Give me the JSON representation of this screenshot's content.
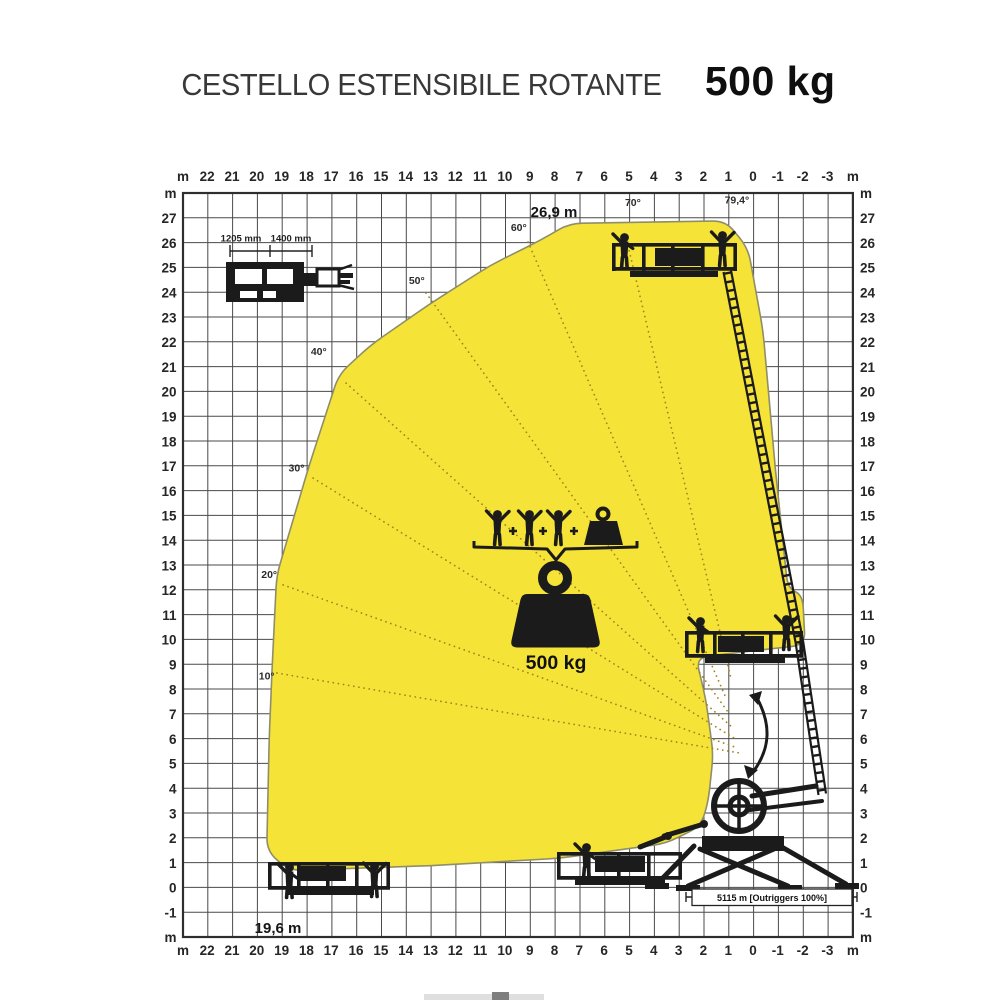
{
  "title": {
    "main": "CESTELLO ESTENSIBILE ROTANTE",
    "capacity": "500 kg"
  },
  "labels": {
    "unit": "m",
    "max_height": "26,9 m",
    "max_outreach": "19,6 m",
    "dim_width_1": "1205 mm",
    "dim_width_2": "1400 mm",
    "outriggers": "5115 m [Outriggers 100%]"
  },
  "pictogram": {
    "capacity_label": "500 kg",
    "persons_count": 3,
    "icons": [
      "person-icon",
      "plus-icon",
      "person-icon",
      "plus-icon",
      "person-icon",
      "plus-icon",
      "case-weight-icon",
      "brace-icon",
      "kettlebell-weight-icon"
    ]
  },
  "chart_data": {
    "type": "area",
    "title": "Working envelope - CESTELLO ESTENSIBILE ROTANTE 500 kg",
    "capacity_kg": 500,
    "max_height_m": 26.9,
    "max_outreach_m": 19.6,
    "grid": true,
    "envelope_color": "#f6e337",
    "x_axis": {
      "unit": "m",
      "ticks": [
        22,
        21,
        20,
        19,
        18,
        17,
        16,
        15,
        14,
        13,
        12,
        11,
        10,
        9,
        8,
        7,
        6,
        5,
        4,
        3,
        2,
        1,
        0,
        -1,
        -2,
        -3
      ]
    },
    "y_axis": {
      "unit": "m",
      "ticks": [
        27,
        26,
        25,
        24,
        23,
        22,
        21,
        20,
        19,
        18,
        17,
        16,
        15,
        14,
        13,
        12,
        11,
        10,
        9,
        8,
        7,
        6,
        5,
        4,
        3,
        2,
        1,
        0,
        -1
      ]
    },
    "envelope_m": [
      [
        7.4,
        26.8
      ],
      [
        1.1,
        26.9
      ],
      [
        0.2,
        25.8
      ],
      [
        -0.4,
        22.5
      ],
      [
        -0.9,
        16.9
      ],
      [
        -1.4,
        12.1
      ],
      [
        -2.0,
        11.8
      ],
      [
        -2.1,
        9.8
      ],
      [
        2.3,
        9.3
      ],
      [
        1.9,
        7.6
      ],
      [
        1.6,
        5.4
      ],
      [
        1.8,
        3.5
      ],
      [
        2.1,
        2.5
      ],
      [
        3.5,
        1.8
      ],
      [
        7.8,
        1.2
      ],
      [
        13.0,
        0.9
      ],
      [
        18.7,
        0.7
      ],
      [
        19.6,
        1.5
      ],
      [
        19.5,
        6.0
      ],
      [
        19.4,
        8.5
      ],
      [
        19.2,
        12.6
      ],
      [
        17.9,
        17.0
      ],
      [
        16.7,
        20.7
      ],
      [
        15.4,
        21.9
      ],
      [
        13.1,
        23.5
      ],
      [
        10.6,
        25.1
      ],
      [
        8.6,
        26.1
      ]
    ],
    "angle_labels": [
      {
        "text": "79,4°",
        "at": [
          0.65,
          27.6
        ]
      },
      {
        "text": "70°",
        "at": [
          4.84,
          27.5
        ]
      },
      {
        "text": "60°",
        "at": [
          9.44,
          26.5
        ]
      },
      {
        "text": "50°",
        "at": [
          13.55,
          24.35
        ]
      },
      {
        "text": "40°",
        "at": [
          17.5,
          21.5
        ]
      },
      {
        "text": "30°",
        "at": [
          18.4,
          16.8
        ]
      },
      {
        "text": "20°",
        "at": [
          19.5,
          12.5
        ]
      },
      {
        "text": "10°",
        "at": [
          19.6,
          8.4
        ]
      }
    ],
    "rays": [
      {
        "angle": 10,
        "from": [
          19.19,
          8.67
        ],
        "to": [
          0.52,
          5.44
        ]
      },
      {
        "angle": 20,
        "from": [
          18.94,
          12.22
        ],
        "to": [
          0.64,
          5.65
        ]
      },
      {
        "angle": 30,
        "from": [
          17.73,
          16.53
        ],
        "to": [
          0.77,
          6.05
        ]
      },
      {
        "angle": 40,
        "from": [
          16.4,
          20.36
        ],
        "to": [
          0.89,
          6.53
        ]
      },
      {
        "angle": 50,
        "from": [
          13.18,
          23.99
        ],
        "to": [
          1.01,
          7.1
        ]
      },
      {
        "angle": 60,
        "from": [
          9.07,
          26.05
        ],
        "to": [
          1.09,
          7.66
        ]
      },
      {
        "angle": 70,
        "from": [
          5.04,
          25.9
        ],
        "to": [
          0.9,
          8.5
        ]
      }
    ]
  }
}
